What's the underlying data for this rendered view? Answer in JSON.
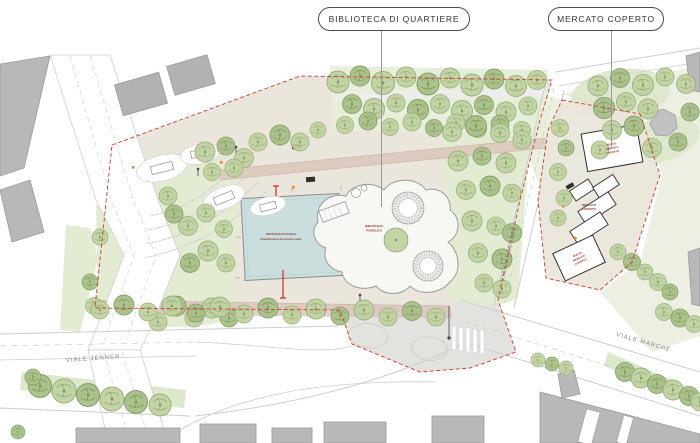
{
  "callouts": {
    "library": {
      "label": "BIBLIOTECA DI QUARTIERE"
    },
    "market": {
      "label": "MERCATO COPERTO"
    }
  },
  "plan": {
    "streets": {
      "jenner": "VIALE JENNER",
      "valassina": "VIA VALASSINA",
      "marche": "VIALE MARCHE"
    },
    "water": {
      "line1": "SPECCHIO D'ACQUA",
      "line2": "Riqualificazione del mercato rionale"
    },
    "library_building": {
      "line1": "BIBLIOTECA",
      "line2": "PUBBLICA"
    },
    "market_area": {
      "line1": "MERCATO",
      "line2": "COPERTO",
      "hall_north": {
        "line1": "NUOVO",
        "line2": "MERCATO",
        "line3": "COPERTO"
      },
      "hall_south": {
        "line1": "NUOVO",
        "line2": "MERCATO",
        "line3": "COPERTO"
      }
    }
  },
  "colors": {
    "site_boundary_red": "#cb3a2e",
    "annotation_red": "#8a3a2c",
    "water_blue": "#c9dedd",
    "tree_green": "#c1d2a2",
    "lawn_green": "#e3ebd3",
    "paving_beige": "#eae6db",
    "path_rose": "#d9c2b7",
    "building_gray": "#b8b8b8"
  }
}
